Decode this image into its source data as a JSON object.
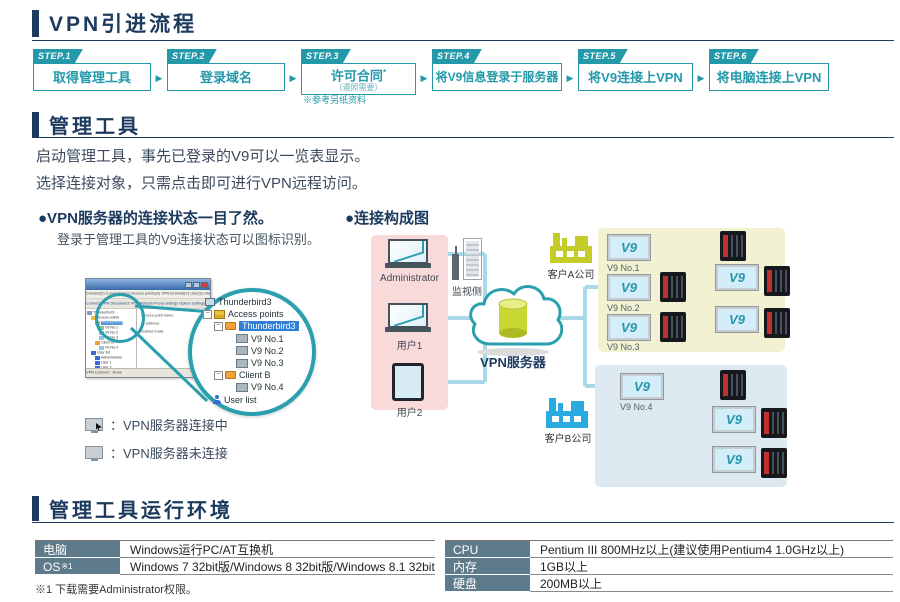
{
  "doc": {
    "title": "VPN引进流程",
    "section_tool": "管理工具",
    "section_env": "管理工具运行环境"
  },
  "steps": {
    "arrow": "▶",
    "items": [
      {
        "badge": "STEP.1",
        "label": "取得管理工具"
      },
      {
        "badge": "STEP.2",
        "label": "登录域名"
      },
      {
        "badge": "STEP.3",
        "label": "许可合同",
        "sup": "*",
        "sublabel": "（遵照需要）",
        "note": "※参考另纸资料"
      },
      {
        "badge": "STEP.4",
        "label": "将V9信息登录于服务器"
      },
      {
        "badge": "STEP.5",
        "label": "将V9连接上VPN"
      },
      {
        "badge": "STEP.6",
        "label": "将电脑连接上VPN"
      }
    ]
  },
  "management_tool": {
    "description_line1": "启动管理工具，事先已登录的V9可以一览表显示。",
    "description_line2": "选择连接对象，只需点击即可进行VPN远程访问。",
    "left_caption": "●VPN服务器的连接状态一目了然。",
    "left_subcaption": "登录于管理工具的V9连接状态可以图标识别。",
    "right_caption": "●连接构成图",
    "legend": {
      "connected": "：VPN服务器连接中",
      "disconnected": "：VPN服务器未连接"
    }
  },
  "tool_window": {
    "menus": "Domain(D)  Connection(C)  Access points(A)  VPN terminal(V)  User(U)  View(V)  Tool(T)  Help(H)",
    "toolbar": "Connect VPN   Disconnect VPN   Refresh   Proxy settings   Option settings",
    "details": [
      "Access point name",
      "IP address",
      "Subnet mask"
    ],
    "status": "VPN Connect : None",
    "tree": [
      {
        "label": "Thunderbird3",
        "icon": "computer",
        "level": 0
      },
      {
        "label": "Access points",
        "icon": "drawer",
        "level": 1
      },
      {
        "label": "Thunderbird3",
        "icon": "folder",
        "level": 2,
        "selected": true
      },
      {
        "label": "V9 No.1",
        "icon": "monitor-connected",
        "level": 3
      },
      {
        "label": "V9 No.2",
        "icon": "monitor",
        "level": 3
      },
      {
        "label": "V9 No.3",
        "icon": "monitor",
        "level": 3
      },
      {
        "label": "Client B",
        "icon": "folder",
        "level": 2
      },
      {
        "label": "V9 No.4",
        "icon": "monitor",
        "level": 3
      },
      {
        "label": "User list",
        "icon": "user",
        "level": 1
      },
      {
        "label": "Administrator",
        "icon": "user",
        "level": 2
      },
      {
        "label": "User 1",
        "icon": "user",
        "level": 2
      },
      {
        "label": "User 2",
        "icon": "user",
        "level": 2
      }
    ]
  },
  "diagram": {
    "administrator": "Administrator",
    "user1": "用户1",
    "user2": "用户2",
    "monitor_side": "监视侧",
    "vpn_server": "VPN服务器",
    "company_a": "客户A公司",
    "company_b": "客户B公司",
    "v9": "V9",
    "v9_no1": "V9 No.1",
    "v9_no2": "V9 No.2",
    "v9_no3": "V9 No.3",
    "v9_no4": "V9 No.4"
  },
  "environment": {
    "left_rows": [
      {
        "key": "电脑",
        "value": "Windows运行PC/AT互换机"
      },
      {
        "key": "OS",
        "sup": "※1",
        "value": "Windows 7 32bit版/Windows 8 32bit版/Windows 8.1 32bit版"
      }
    ],
    "right_rows": [
      {
        "key": "CPU",
        "value": "Pentium III 800MHz以上(建议使用Pentium4 1.0GHz以上)"
      },
      {
        "key": "内存",
        "value": "1GB以上"
      },
      {
        "key": "硬盘",
        "value": "200MB以上"
      }
    ],
    "footnote": "※1 下载需要Administrator权限。"
  },
  "colors": {
    "navy": "#1c3a5e",
    "teal": "#2399aa",
    "pink_box": "#f9dada",
    "yellow_box": "#f2f2d2",
    "blue_box": "#dde9f0",
    "line_blue": "#a8d8ea",
    "factory_a": "#c5cc29",
    "factory_b": "#2aabdf",
    "table_header": "#5e7b8b"
  }
}
